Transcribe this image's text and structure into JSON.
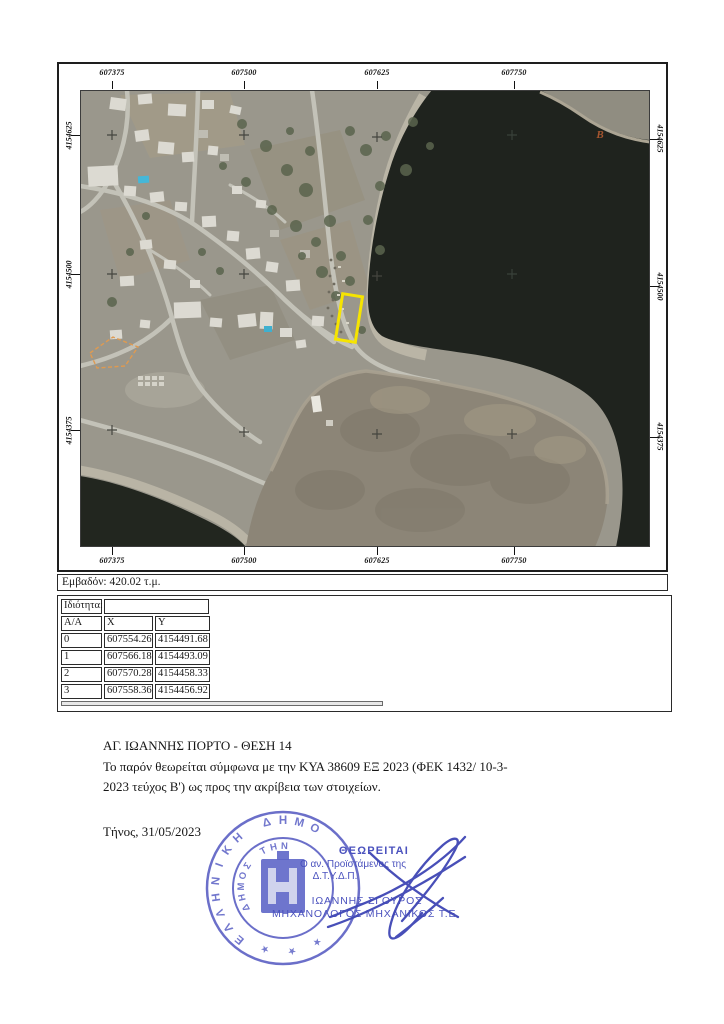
{
  "map": {
    "x_labels": [
      "607375",
      "607500",
      "607625",
      "607750"
    ],
    "y_labels": [
      "4154625",
      "4154500",
      "4154375"
    ],
    "point_b_label": "Β",
    "area_label": "Εμβαδόν: 420.02 τ.μ.",
    "plot_outline_color": "#f6e400",
    "reference_outline_color": "#df9a50",
    "point_b_color": "#a4552f"
  },
  "table": {
    "property_label": "Ιδιότητα:",
    "property_value": "",
    "headers": [
      "Α/Α",
      "X",
      "Y"
    ],
    "rows": [
      [
        "0",
        "607554.26",
        "4154491.68"
      ],
      [
        "1",
        "607566.18",
        "4154493.09"
      ],
      [
        "2",
        "607570.28",
        "4154458.33"
      ],
      [
        "3",
        "607558.36",
        "4154456.92"
      ]
    ]
  },
  "text": {
    "title": "ΑΓ. ΙΩΑΝΝΗΣ ΠΟΡΤΟ - ΘΕΣΗ 14",
    "body_line1": "Το παρόν θεωρείται σύμφωνα με την ΚΥΑ 38609 ΕΞ 2023 (ΦΕΚ 1432/ 10-3-",
    "body_line2": "2023 τεύχος Β') ως προς την ακρίβεια των στοιχείων.",
    "place_date": "Τήνος, 31/05/2023"
  },
  "stamp": {
    "ring_outer_text": "ΕΛΛΗΝΙΚΗ ΔΗΜΟ",
    "ring_inner_text": "ΔΗΜΟΣ ΤΗΝ",
    "star": "★",
    "approved_label": "ΘΕΩΡΕΙΤΑΙ",
    "role_line1": "Ο αν. Προϊστάμενος της",
    "role_line2": "Δ.Τ.Υ.Δ.Π.",
    "name": "ΙΩΑΝΝΗΣ ΣΓΟΥΡΟΣ",
    "title": "ΜΗΧΑΝΟΛΟΓΟΣ ΜΗΧΑΝΙΚΟΣ Τ.Ε.",
    "color": "#4b52be"
  }
}
